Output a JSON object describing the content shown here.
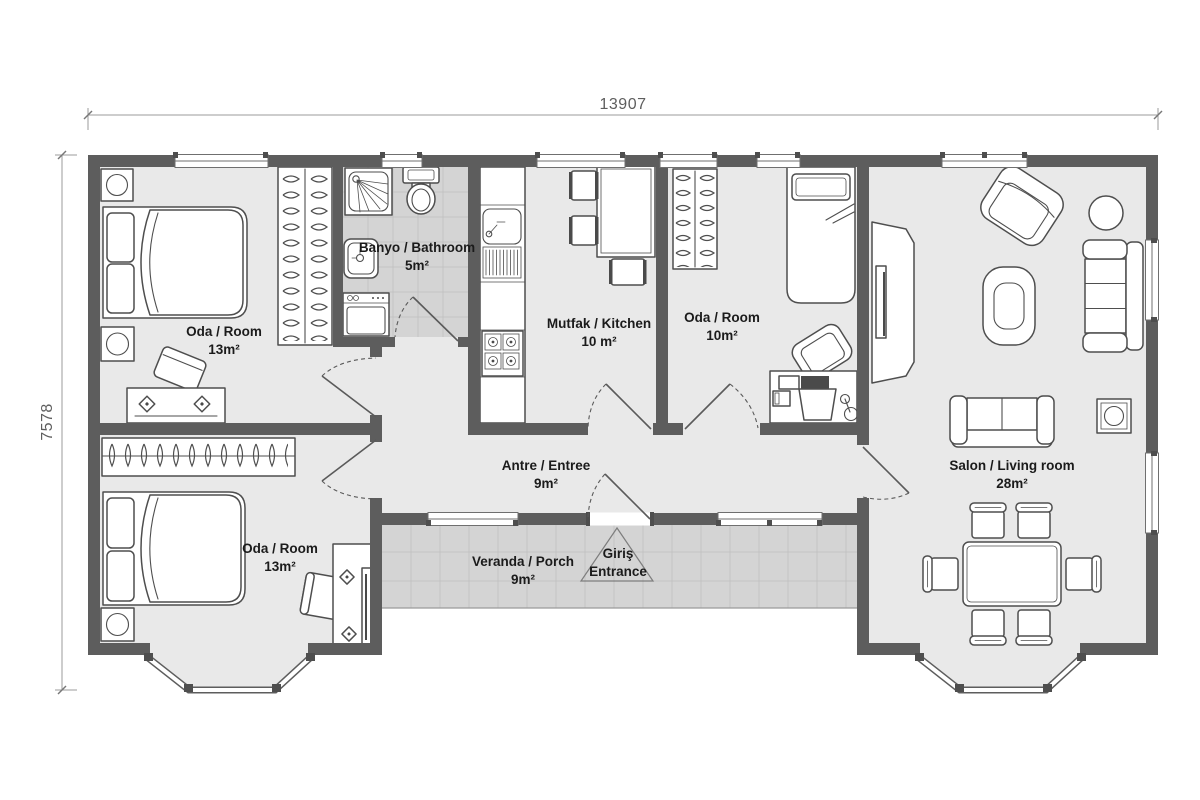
{
  "plan": {
    "dimensions": {
      "width": "13907",
      "height": "7578"
    },
    "rooms": [
      {
        "id": "bedroom-top-left",
        "name": "Oda / Room",
        "area": "13m²"
      },
      {
        "id": "bathroom",
        "name": "Banyo / Bathroom",
        "area": "5m²"
      },
      {
        "id": "kitchen",
        "name": "Mutfak / Kitchen",
        "area": "10 m²"
      },
      {
        "id": "bedroom-middle",
        "name": "Oda / Room",
        "area": "10m²"
      },
      {
        "id": "living-room",
        "name": "Salon / Living room",
        "area": "28m²"
      },
      {
        "id": "bedroom-bottom-left",
        "name": "Oda / Room",
        "area": "13m²"
      },
      {
        "id": "hall",
        "name": "Antre / Entree",
        "area": "9m²"
      },
      {
        "id": "porch",
        "name": "Veranda / Porch",
        "area": "9m²"
      }
    ],
    "entrance": {
      "line1": "Giriş",
      "line2": "Entrance"
    },
    "colors": {
      "wall": "#5d5d5d",
      "floor": "#e9e9e9",
      "tile": "#d4d4d4",
      "tile_line": "#c3c3c3",
      "furniture_outline": "#4e4e4e",
      "label_text": "#1b1b1b",
      "dimension_text": "#5e5e5e"
    }
  }
}
